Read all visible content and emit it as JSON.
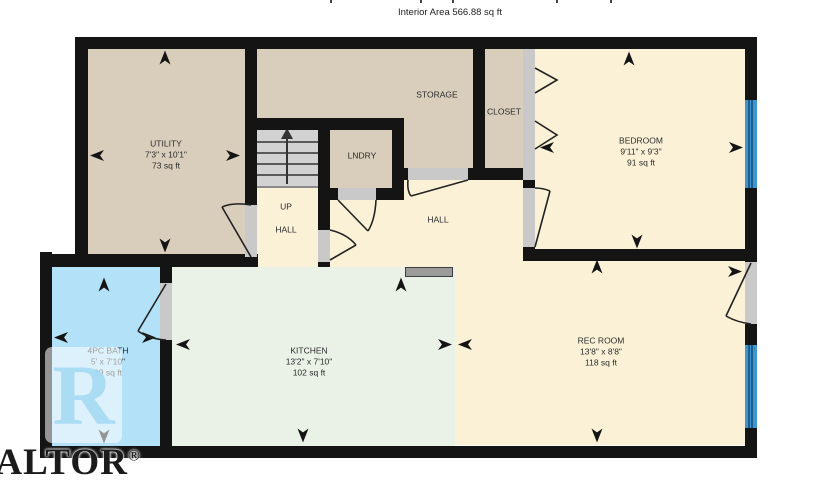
{
  "title": {
    "interior_area": "Interior Area 566.88 sq ft"
  },
  "rooms": {
    "utility": {
      "label": "UTILITY",
      "dims": "7'3\" x 10'1\"",
      "area": "73 sq ft"
    },
    "storage": {
      "label": "STORAGE"
    },
    "closet": {
      "label": "CLOSET"
    },
    "laundry": {
      "label": "LNDRY"
    },
    "bedroom": {
      "label": "BEDROOM",
      "dims": "9'11\" x 9'3\"",
      "area": "91 sq ft"
    },
    "stair_hall": {
      "up_label": "UP",
      "label": "HALL"
    },
    "hall": {
      "label": "HALL"
    },
    "bath": {
      "label": "4PC BATH",
      "dims": "5' x 7'10\"",
      "area": "39 sq ft"
    },
    "kitchen": {
      "label": "KITCHEN",
      "dims": "13'2\" x 7'10\"",
      "area": "102 sq ft"
    },
    "rec_room": {
      "label": "REC ROOM",
      "dims": "13'8\" x 8'8\"",
      "area": "118 sq ft"
    }
  },
  "watermark": {
    "logo_letter": "R",
    "brand_text": "REALTOR",
    "registered_mark": "®"
  },
  "colors": {
    "wall": "#141414",
    "cream": "#faf1d7",
    "tan": "#d9cdbc",
    "mint": "#eaf2e8",
    "bath-blue": "#b3e1f8",
    "window": "#4095cc",
    "stairs": "#d2d2d2",
    "opening": "#c9c9c9"
  },
  "icons": {
    "dimension_arrow": "concave-arrowhead",
    "stairs_direction": "up-arrow",
    "closet_doors": "bifold-chevrons"
  }
}
